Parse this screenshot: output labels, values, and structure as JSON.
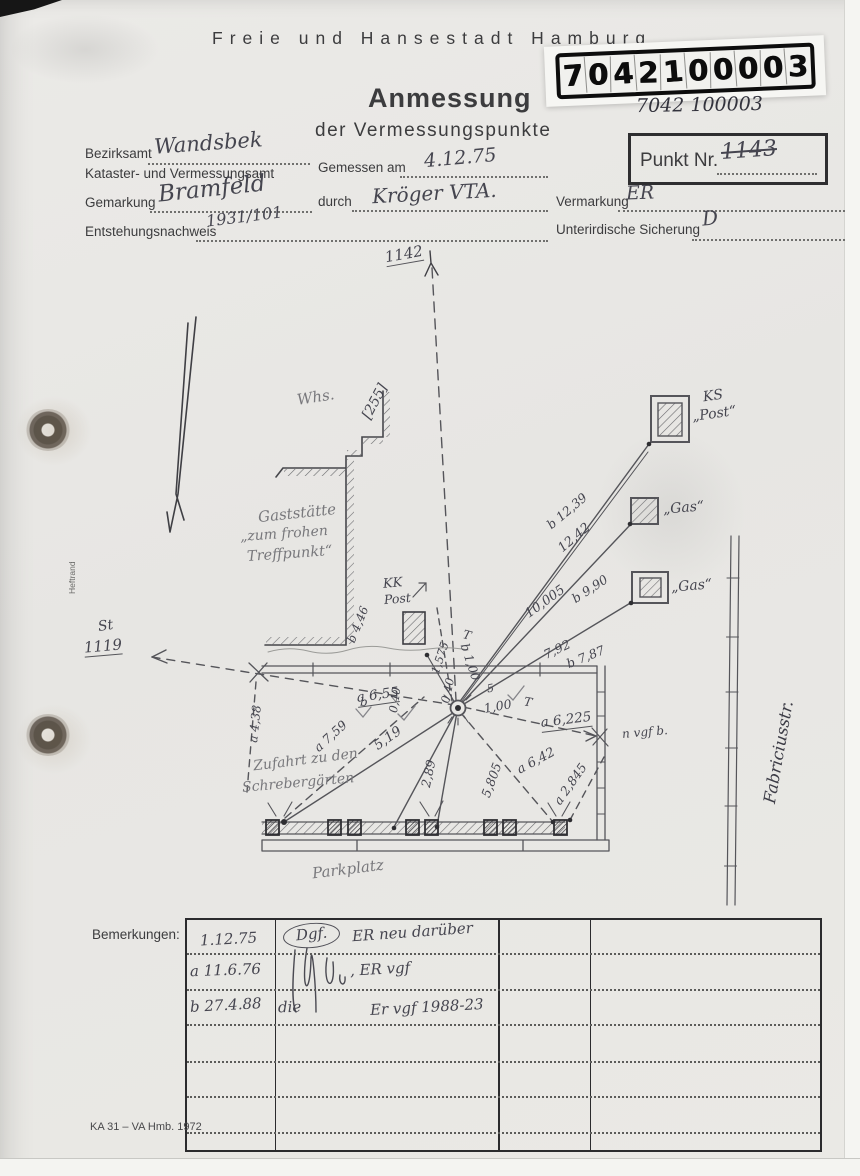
{
  "header": {
    "city": "Freie und Hansestadt Hamburg",
    "title": "Anmessung",
    "subtitle": "der Vermessungspunkte",
    "stamp_digits": [
      "7",
      "0",
      "4",
      "2",
      "1",
      "0",
      "0",
      "0",
      "0",
      "3"
    ],
    "stamp_handwritten": "7042 100003",
    "punkt_label": "Punkt Nr.",
    "punkt_value": "1143"
  },
  "form": {
    "bezirksamt_label": "Bezirksamt",
    "bezirksamt_value": "Wandsbek",
    "kataster_label": "Kataster- und Vermessungsamt",
    "gemessen_label": "Gemessen am",
    "gemessen_value": "4.12.75",
    "gemarkung_label": "Gemarkung",
    "gemarkung_value": "Bramfeld",
    "durch_label": "durch",
    "durch_value": "Kröger VTA.",
    "vermarkung_label": "Vermarkung",
    "vermarkung_value": "ER",
    "entstehung_label": "Entstehungsnachweis",
    "entstehung_value": "1931/101",
    "sicherung_label": "Unterirdische Sicherung",
    "sicherung_value": "D",
    "heftrand": "Heftrand"
  },
  "sketch": {
    "labels": {
      "point_1142": "1142",
      "whs": "Whs.",
      "bracket_255": "[255]",
      "gast_line1": "Gaststätte",
      "gast_line2": "„zum frohen",
      "gast_line3": "Treffpunkt“",
      "kk": "KK",
      "kk_post": "Post",
      "ks": "KS",
      "ks_post": "„Post“",
      "gas_1": "„Gas“",
      "gas_2": "„Gas“",
      "st": "St",
      "st_1119": "1119",
      "m_b12_39": "b 12,39",
      "m_12_42": "12,42",
      "m_10_005": "10,005",
      "m_b9_90": "b 9,90",
      "m_7_92": "7,92",
      "m_b7_87": "b 7,87",
      "m_b4_46": "b 4,46",
      "m_1_575": "1,575",
      "m_0_40_a": "0,40",
      "m_0_40_b": "0,40",
      "t_b": "T",
      "m_b1_00": "b 1,00",
      "m_a6_55": "a 6,55",
      "b_mark": "b",
      "five_mark": "5",
      "m_1_00": "1,00",
      "t_a": "T",
      "m_a6_225": "a 6,225",
      "n_vgf_b": "n vgf b.",
      "m_a4_38": "a 4,38",
      "m_a7_59": "a 7,59",
      "m_5_19": "5,19",
      "m_2_89": "2,89",
      "m_5_805": "5,805",
      "m_a6_42": "a 6,42",
      "m_a2_845": "a 2,845",
      "zufahrt_line1": "Zufahrt zu den",
      "zufahrt_line2": "Schrebergärten",
      "parkplatz": "Parkplatz",
      "fabriciusstr": "Fabriciusstr."
    }
  },
  "remarks": {
    "label": "Bemerkungen:",
    "rows": [
      {
        "date": "1.12.75",
        "note_a": "Dgf.",
        "note_b": "ER neu darüber"
      },
      {
        "date": "a 11.6.76",
        "note_a": "",
        "note_b": ", ER vgf"
      },
      {
        "date": "b 27.4.88",
        "note_a": "die",
        "note_b": "Er vgf 1988-23"
      }
    ]
  },
  "footer": {
    "form_code": "KA 31 – VA Hmb. 1972"
  }
}
